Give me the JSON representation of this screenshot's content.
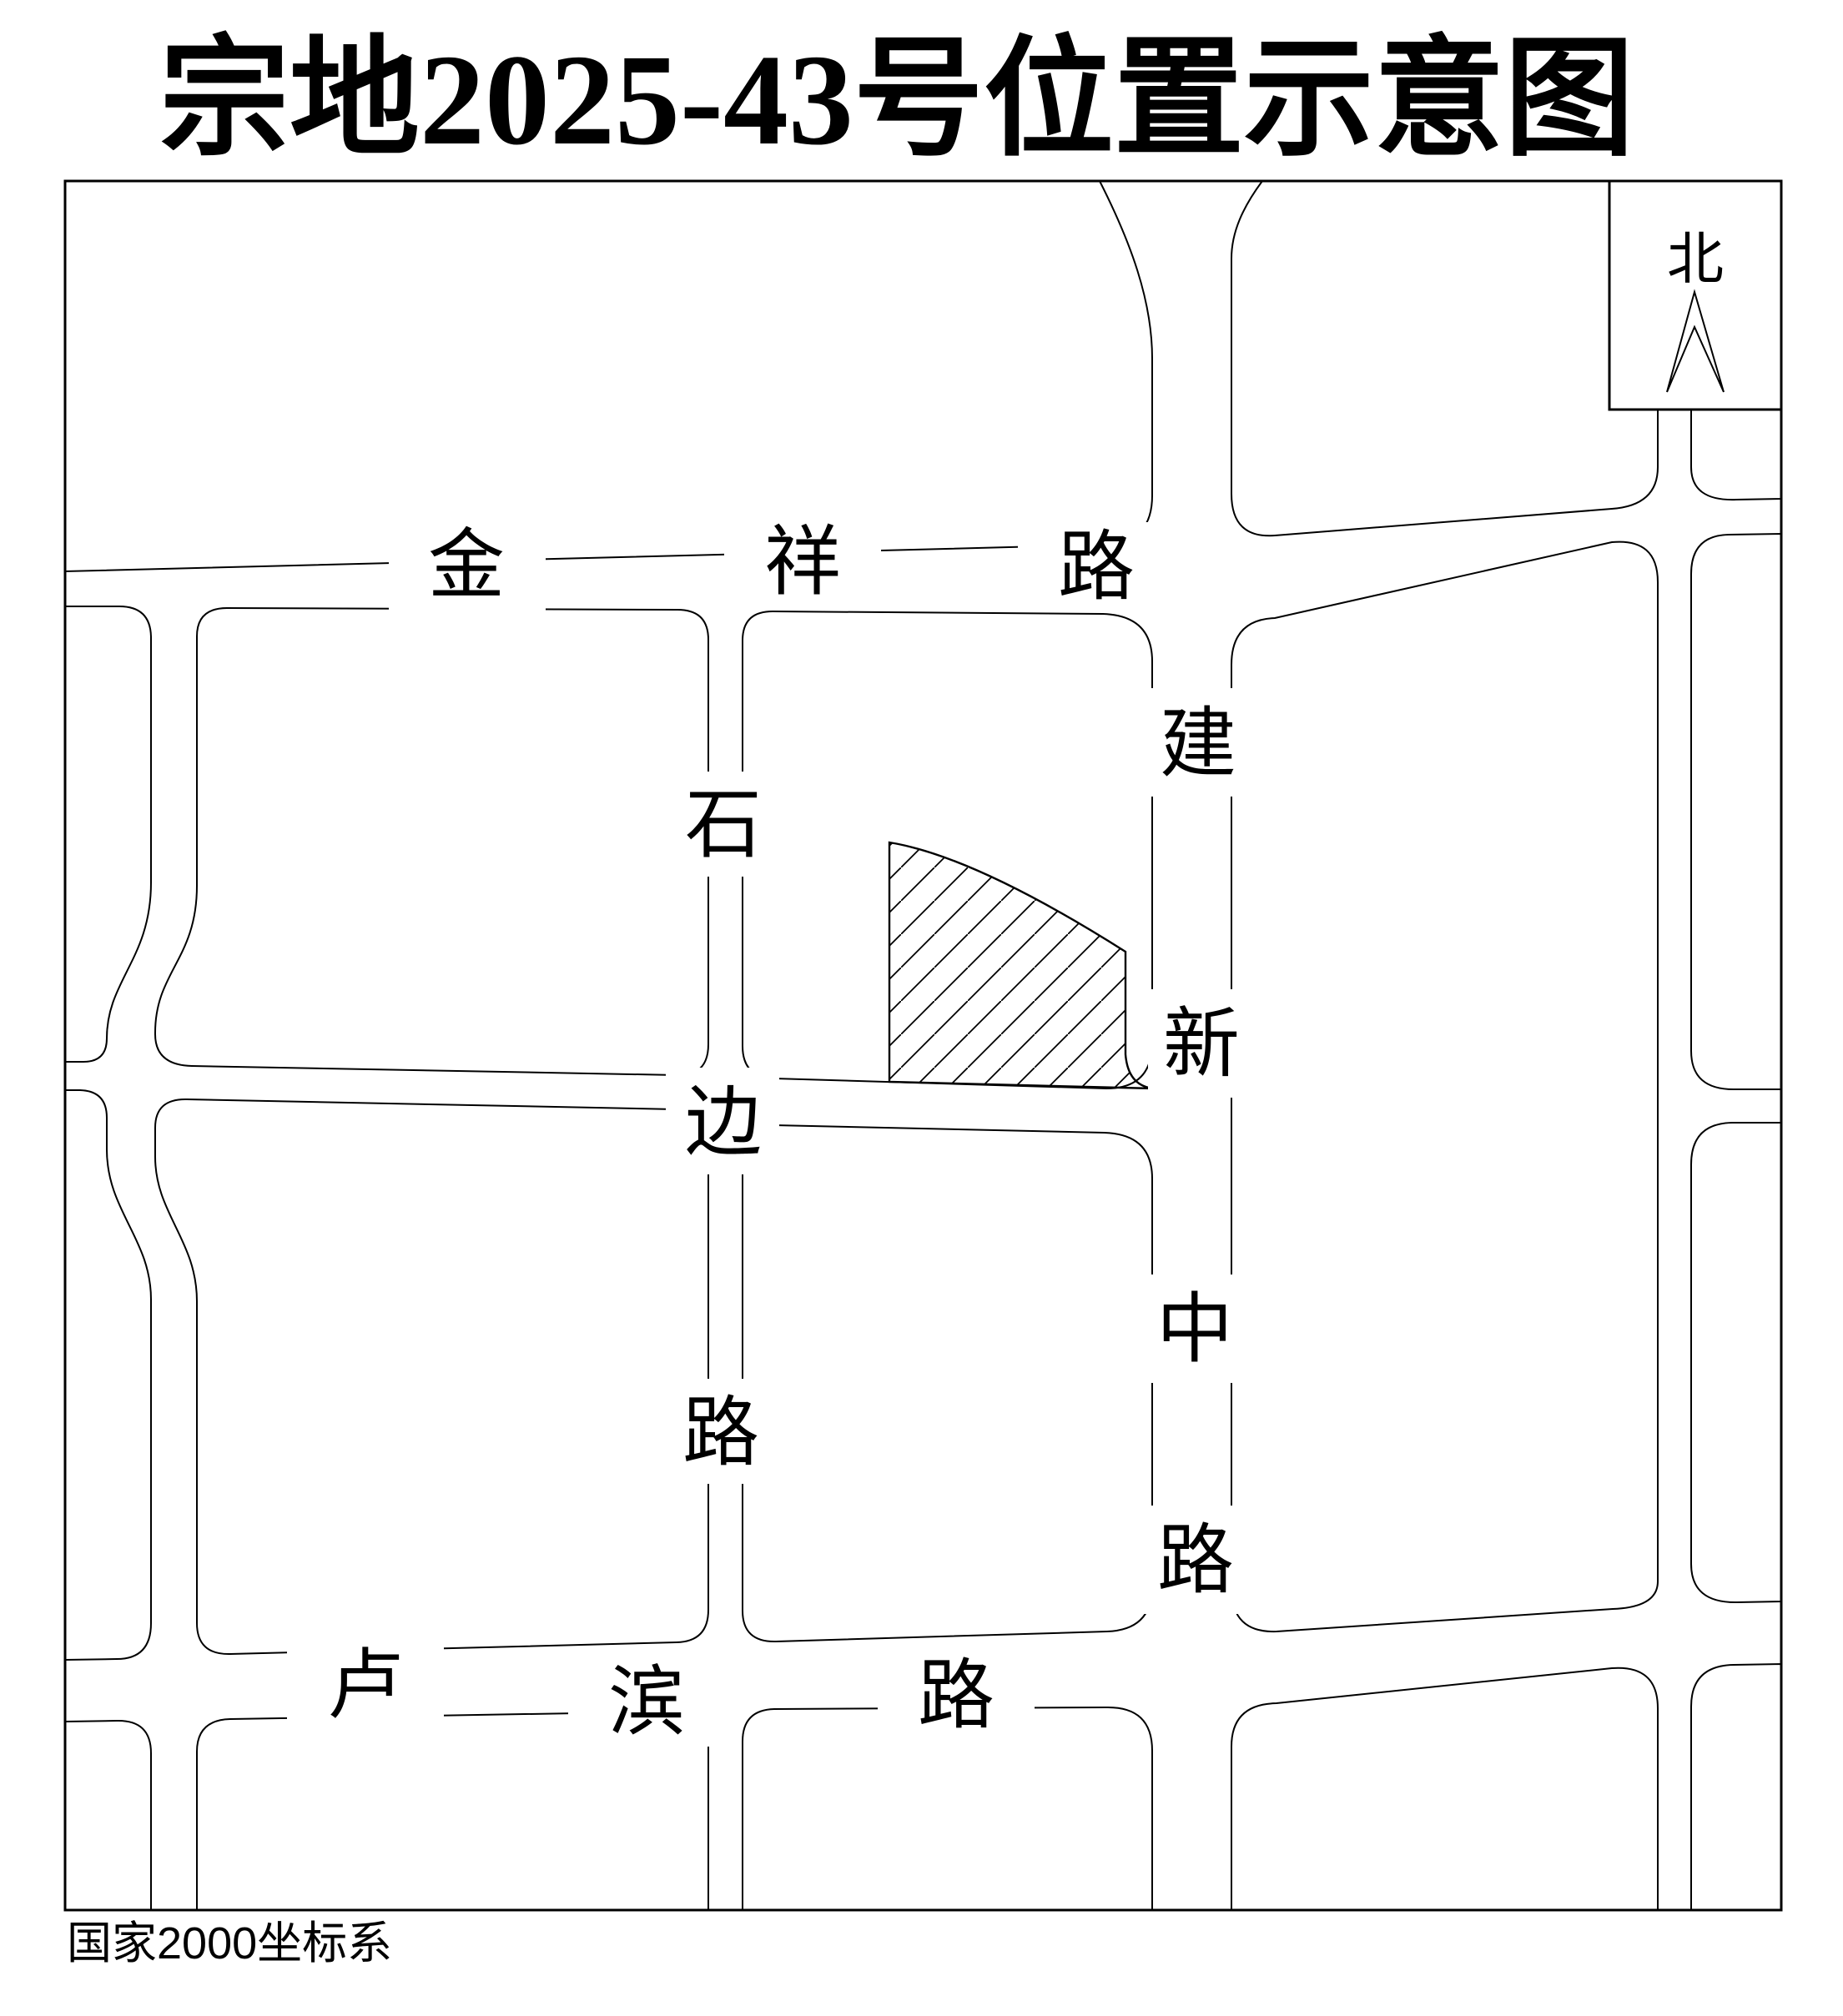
{
  "title": "宗地2025-43号位置示意图",
  "north": {
    "label": "北"
  },
  "footer": {
    "coordinate_system": "国家2000坐标系"
  },
  "roads": [
    {
      "name": "金祥路",
      "orientation": "horizontal",
      "chars": [
        "金",
        "祥",
        "路"
      ]
    },
    {
      "name": "石边路",
      "orientation": "vertical",
      "chars": [
        "石",
        "边",
        "路"
      ]
    },
    {
      "name": "建新中路",
      "orientation": "vertical",
      "chars": [
        "建",
        "新",
        "中",
        "路"
      ]
    },
    {
      "name": "卢滨路",
      "orientation": "horizontal",
      "chars": [
        "卢",
        "滨",
        "路"
      ]
    }
  ],
  "parcel": {
    "id": "2025-43",
    "fill_style": "diagonal-hatch"
  },
  "colors": {
    "line": "#000000",
    "background": "#ffffff",
    "text": "#000000"
  }
}
